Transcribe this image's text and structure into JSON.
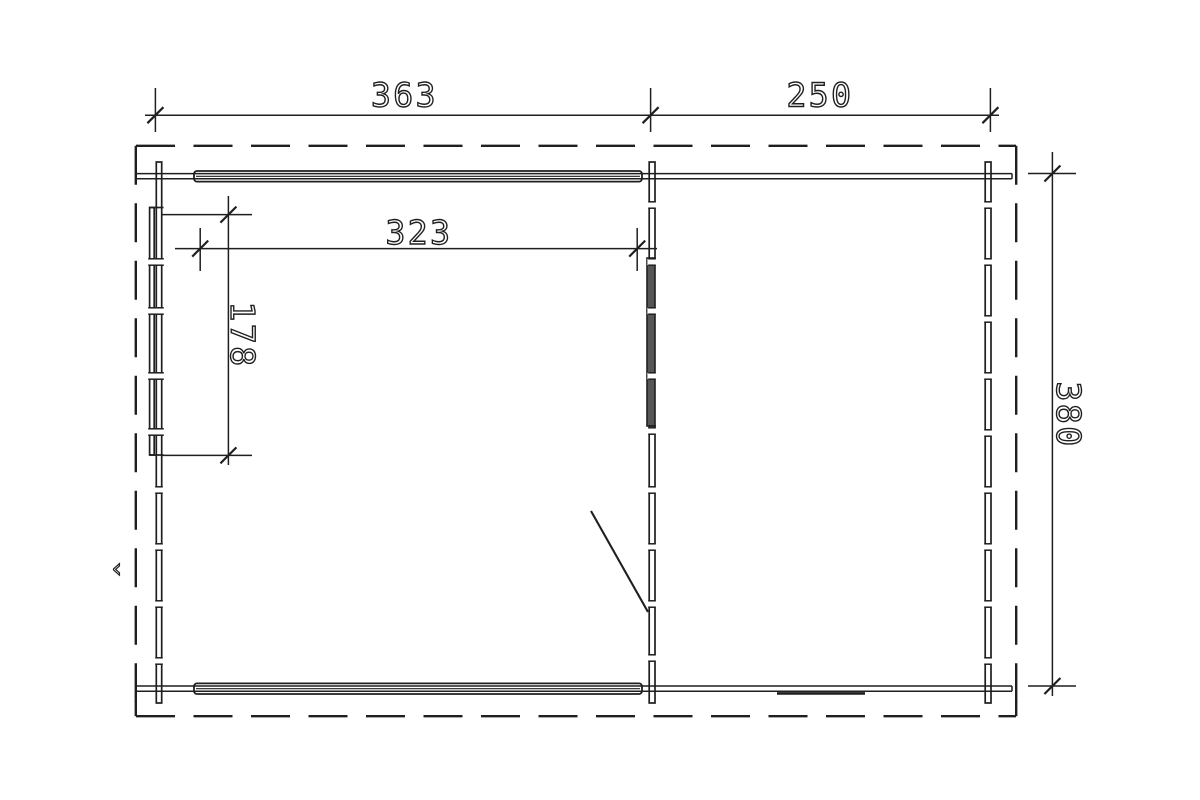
{
  "drawing": {
    "type": "floor-plan",
    "background_color": "#ffffff",
    "line_color": "#1f1f1f",
    "window_fill_color": "#565656",
    "dimensions": {
      "top_span_left": "363",
      "top_span_right": "250",
      "interior_width": "323",
      "left_wall_opening": "178",
      "side_depth": "380"
    },
    "stray_mark": "‹"
  }
}
